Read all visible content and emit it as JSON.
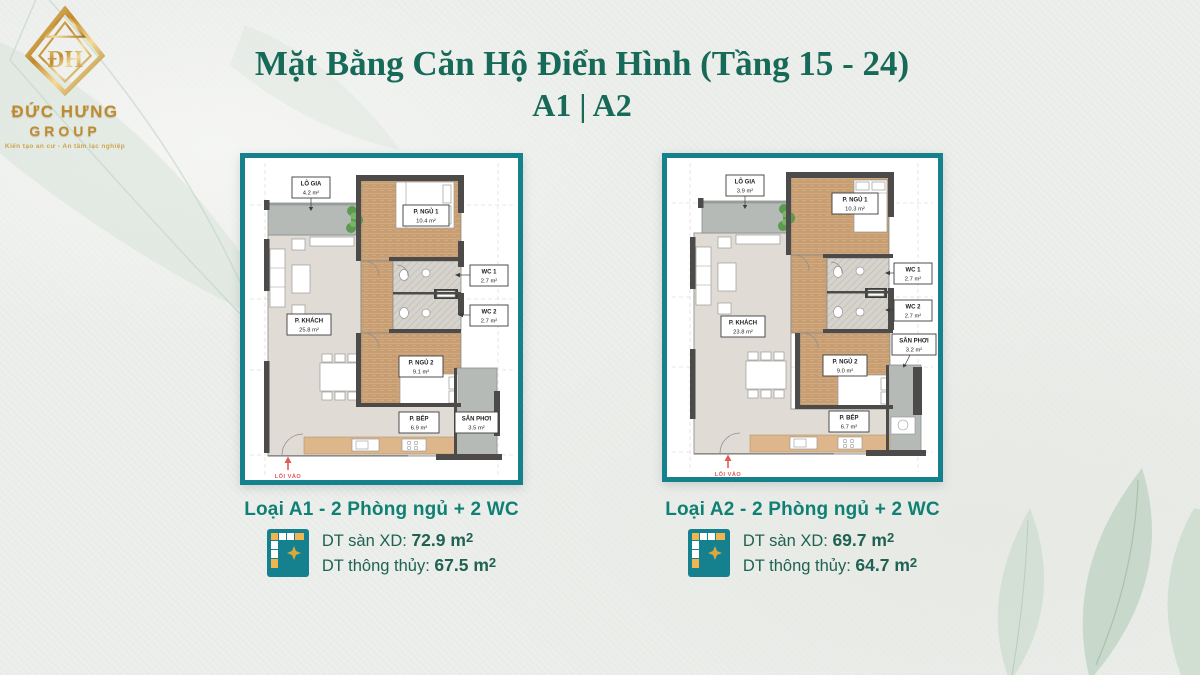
{
  "logo": {
    "name": "ĐỨC HƯNG",
    "group": "GROUP",
    "tagline": "Kiến tạo an cư - An tâm lạc nghiệp"
  },
  "title": {
    "line1": "Mặt Bằng Căn Hộ Điển Hình (Tầng 15 - 24)",
    "line2": "A1 | A2"
  },
  "colors": {
    "title_green": "#176a58",
    "caption_teal": "#0f8073",
    "dt_green": "#1e6253",
    "frame_teal": "#15818d",
    "logo_gold": "#bd8c32",
    "entrance_red": "#e25a57"
  },
  "plans": [
    {
      "id": "A1",
      "entrance": "LỐI VÀO",
      "rooms": {
        "logia": {
          "name": "LÔ GIA",
          "area": "4.2 m²"
        },
        "bedroom1": {
          "name": "P. NGỦ 1",
          "area": "10.4 m²"
        },
        "wc1": {
          "name": "WC 1",
          "area": "2.7 m²"
        },
        "wc2": {
          "name": "WC 2",
          "area": "2.7 m²"
        },
        "living": {
          "name": "P. KHÁCH",
          "area": "25.8 m²"
        },
        "bedroom2": {
          "name": "P. NGỦ 2",
          "area": "9.1 m²"
        },
        "kitchen": {
          "name": "P. BẾP",
          "area": "6.9 m²"
        },
        "sanphoi": {
          "name": "SÂN PHƠI",
          "area": "3.5 m²"
        }
      },
      "caption": {
        "type_label": "Loại A1 - 2 Phòng ngủ + 2 WC",
        "gfa_label": "DT sàn XD:",
        "gfa_value": "72.9 m",
        "nfa_label": "DT thông thủy:",
        "nfa_value": "67.5 m",
        "sup": "2"
      }
    },
    {
      "id": "A2",
      "entrance": "LỐI VÀO",
      "rooms": {
        "logia": {
          "name": "LÔ GIA",
          "area": "3.9 m²"
        },
        "bedroom1": {
          "name": "P. NGỦ 1",
          "area": "10.3 m²"
        },
        "wc1": {
          "name": "WC 1",
          "area": "2.7 m²"
        },
        "wc2": {
          "name": "WC 2",
          "area": "2.7 m²"
        },
        "living": {
          "name": "P. KHÁCH",
          "area": "23.8 m²"
        },
        "bedroom2": {
          "name": "P. NGỦ 2",
          "area": "9.0 m²"
        },
        "kitchen": {
          "name": "P. BẾP",
          "area": "6.7 m²"
        },
        "sanphoi": {
          "name": "SÂN PHƠI",
          "area": "3.2 m²"
        }
      },
      "caption": {
        "type_label": "Loại A2 - 2 Phòng ngủ + 2 WC",
        "gfa_label": "DT sàn XD:",
        "gfa_value": "69.7 m",
        "nfa_label": "DT thông thủy:",
        "nfa_value": "64.7 m",
        "sup": "2"
      }
    }
  ]
}
